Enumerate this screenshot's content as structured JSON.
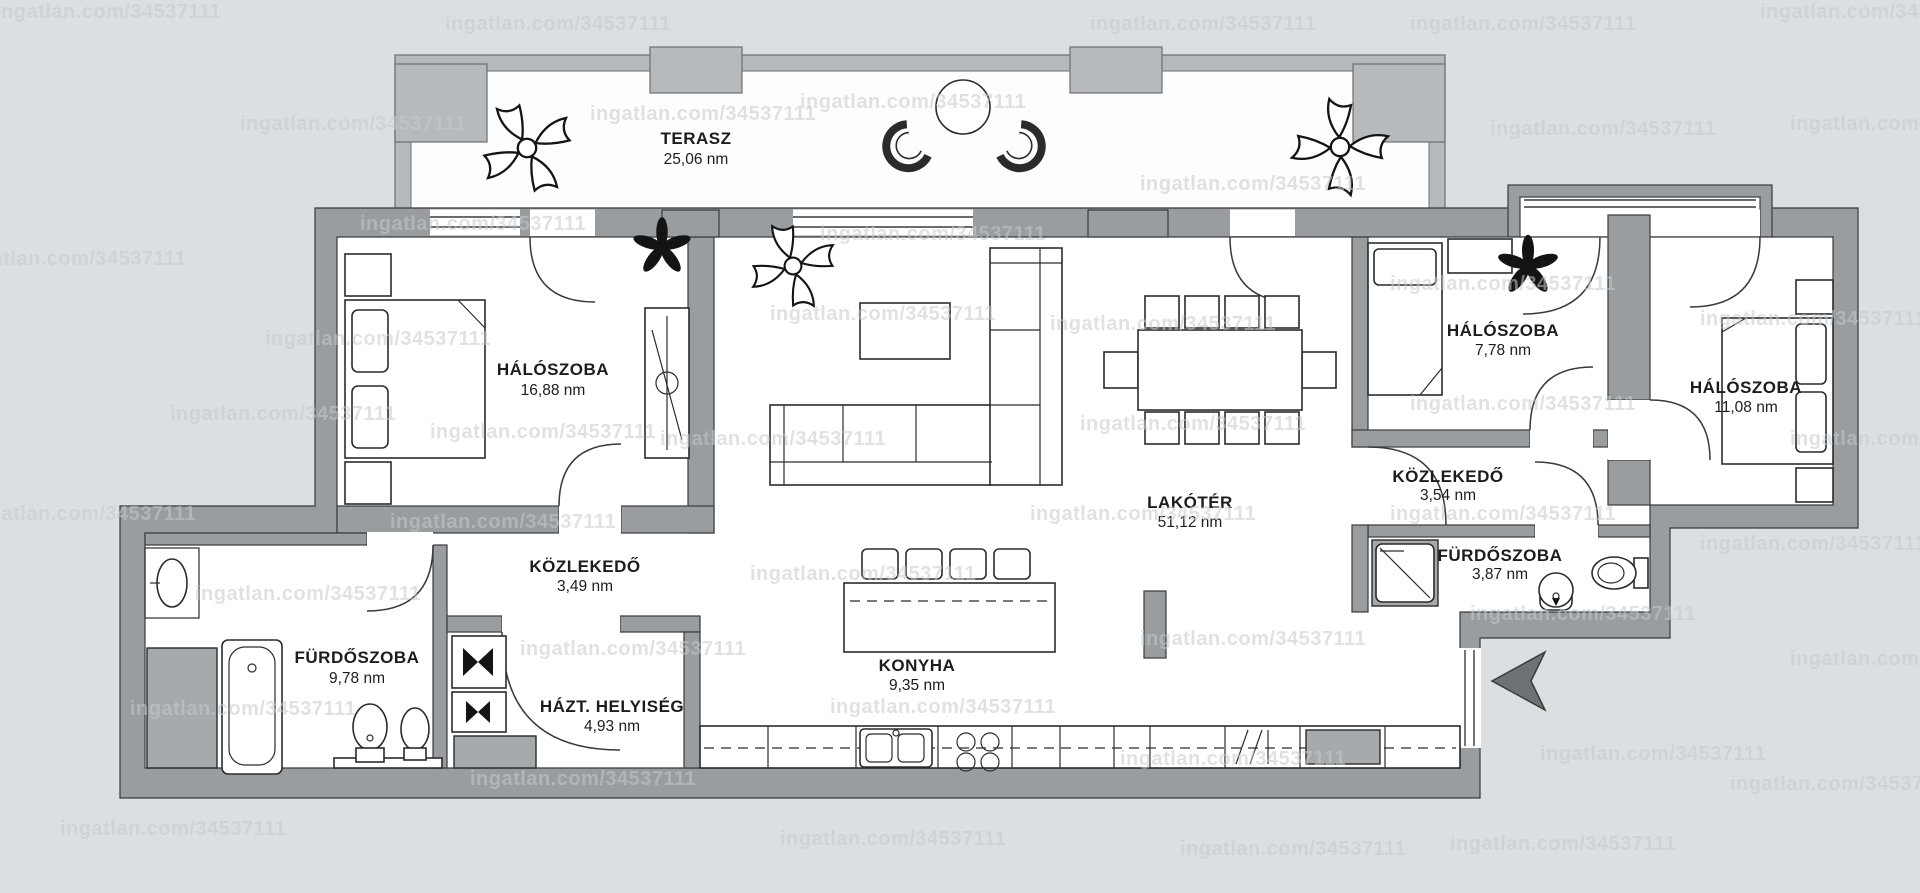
{
  "watermark": {
    "text": "ingatlan.com/34537111"
  },
  "plan": {
    "rooms": [
      {
        "id": "terasz",
        "name": "TERASZ",
        "area": "25,06 nm"
      },
      {
        "id": "haloszoba-1",
        "name": "HÁLÓSZOBA",
        "area": "16,88 nm"
      },
      {
        "id": "kozlekedo-1",
        "name": "KÖZLEKEDŐ",
        "area": "3,49 nm"
      },
      {
        "id": "furdoszoba-1",
        "name": "FÜRDŐSZOBA",
        "area": "9,78 nm"
      },
      {
        "id": "hazt-helyiseg",
        "name": "HÁZT. HELYISÉG",
        "area": "4,93 nm"
      },
      {
        "id": "konyha",
        "name": "KONYHA",
        "area": "9,35 nm"
      },
      {
        "id": "lakoter",
        "name": "LAKÓTÉR",
        "area": "51,12 nm"
      },
      {
        "id": "haloszoba-2",
        "name": "HÁLÓSZOBA",
        "area": "7,78 nm"
      },
      {
        "id": "kozlekedo-2",
        "name": "KÖZLEKEDŐ",
        "area": "3,54 nm"
      },
      {
        "id": "furdoszoba-2",
        "name": "FÜRDŐSZOBA",
        "area": "3,87 nm"
      },
      {
        "id": "haloszoba-3",
        "name": "HÁLÓSZOBA",
        "area": "11,08 nm"
      }
    ],
    "colors": {
      "background": "#dcdfe1",
      "wall": "#9a9da0",
      "terrace_wall": "#b7babc",
      "floor": "#ffffff",
      "line": "#2b2b2b",
      "appliance": "#a7aaac",
      "watermark_text": "#c6cacd"
    }
  }
}
